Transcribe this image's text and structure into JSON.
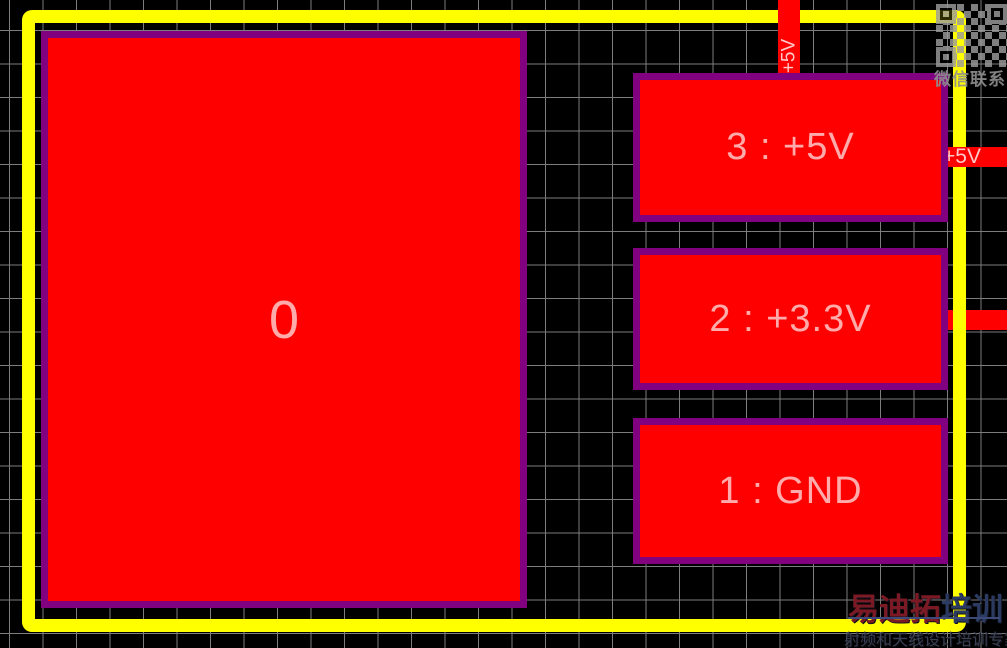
{
  "pcb": {
    "big_pad_label": "0",
    "pad3_label": "3 : +5V",
    "pad2_label": "2 : +3.3V",
    "pad1_label": "1 : GND",
    "net_top_label": "+5V",
    "net_right_label": "+5V"
  },
  "overlay": {
    "wechat_text": "微信联系",
    "watermark_title_red": "易迪拓",
    "watermark_title_blue": "培训",
    "watermark_subtitle": "射频和天线设计培训专家"
  },
  "colors": {
    "background": "#000000",
    "grid_line": "#7d7d7d",
    "board_outline": "#ffff00",
    "pad_fill": "#ff0000",
    "pad_border": "#800080",
    "pad_text": "#ffabab",
    "trace_fill": "#ff0000",
    "trace_text": "#ffc9c9",
    "watermark_red": "#7b1a24",
    "watermark_blue": "#2a3a60",
    "qr_gray": "#9c9c9c"
  }
}
